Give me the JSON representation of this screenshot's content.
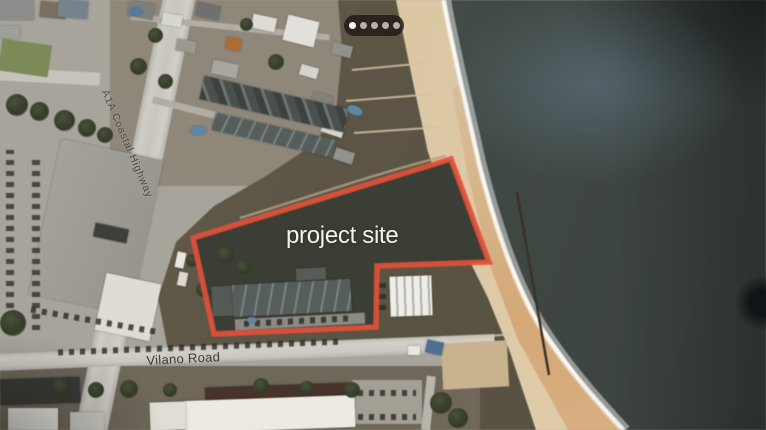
{
  "image": {
    "kind": "aerial-satellite-photo",
    "description": "Oblique aerial view of a Vilano Beach oceanfront parcel with the project site outlined in red"
  },
  "carousel": {
    "dots": [
      "active",
      "inactive",
      "inactive",
      "inactive",
      "inactive"
    ]
  },
  "map": {
    "site_label": "project site",
    "highway_label": "A1A Coastal Highway",
    "road_label": "Vilano Road",
    "annotation": {
      "polygon_points": "451,159 489,262 377,266 376,327 214,334 193,238",
      "outline_color": "#e2503a"
    },
    "palette": {
      "ocean": "#414944",
      "beach": "#dcc7a3",
      "dune_scrub": "#5d5546",
      "site_fill": "#3b3e35",
      "road": "#cfccc5"
    }
  }
}
